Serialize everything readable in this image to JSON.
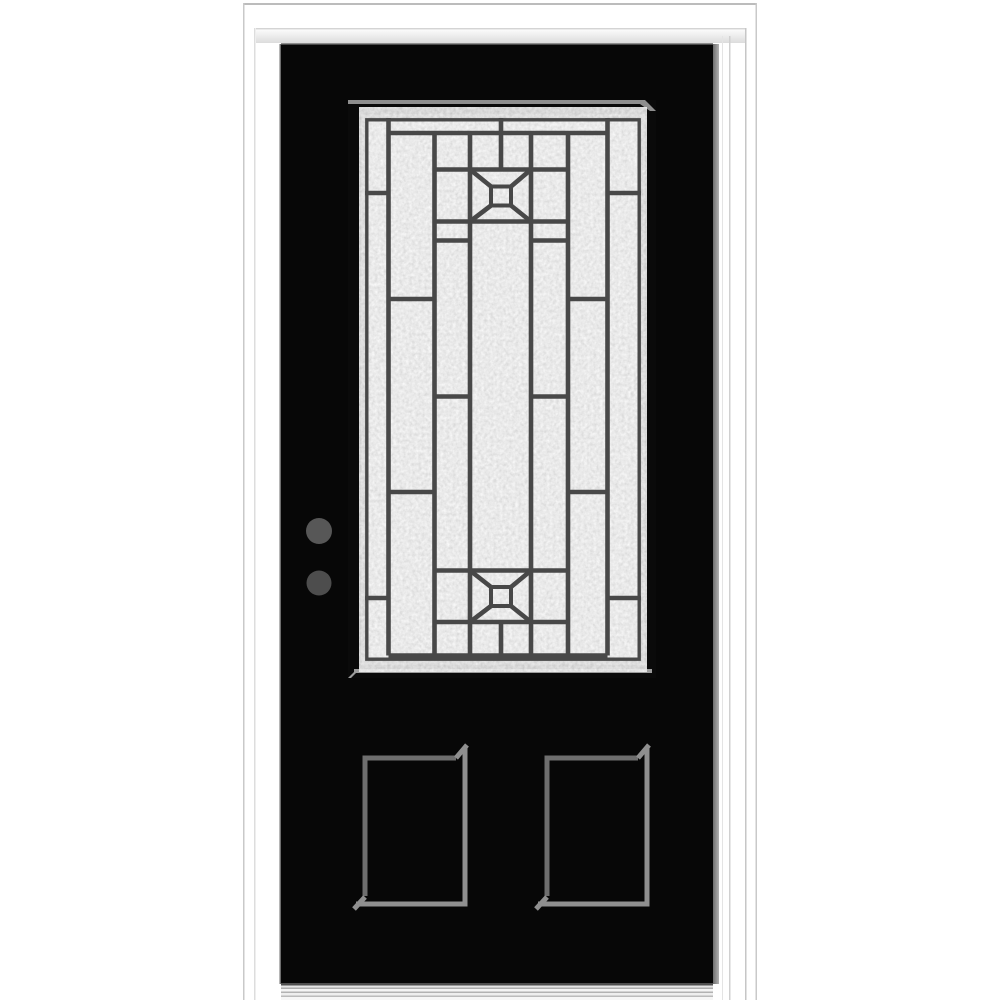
{
  "image": {
    "alt": "Product photo of a black single prehung front entry door with white frame, decorative 3/4-lite caming glass, two bottom recessed panels and metal sill",
    "background": "#ffffff"
  },
  "frame": {
    "material_color": "#ffffff",
    "outer_line_color": "#bcbcbc",
    "inner_line_color": "#d6d6d6"
  },
  "door": {
    "slab_color": "#070707",
    "edge_highlight_color": "#9a9a9a",
    "top_seam_color": "#8d8d8d"
  },
  "glass": {
    "style": "decorative-caming-3-4-lite",
    "base_color": "#e9e9e9",
    "caming_color": "#484848",
    "bezel_color": "#0a0a0a",
    "bezel_highlight_color": "#929292",
    "motif_count": 2,
    "motif": "square-with-x-and-center-square"
  },
  "hardware": {
    "bore_hole_count": 2,
    "bore_hole_top_color": "#575757",
    "bore_hole_bottom_color": "#4d4d4d"
  },
  "panels": {
    "count": 2,
    "stroke_dark": "#6e6e6e",
    "stroke_light": "#8f8f8f"
  },
  "sill": {
    "finish": "brushed-aluminum-stripes",
    "dark_stripe": "#b2b2b2",
    "light_stripe": "#f4f4f4",
    "shadow_line": "#4f4f4f"
  }
}
